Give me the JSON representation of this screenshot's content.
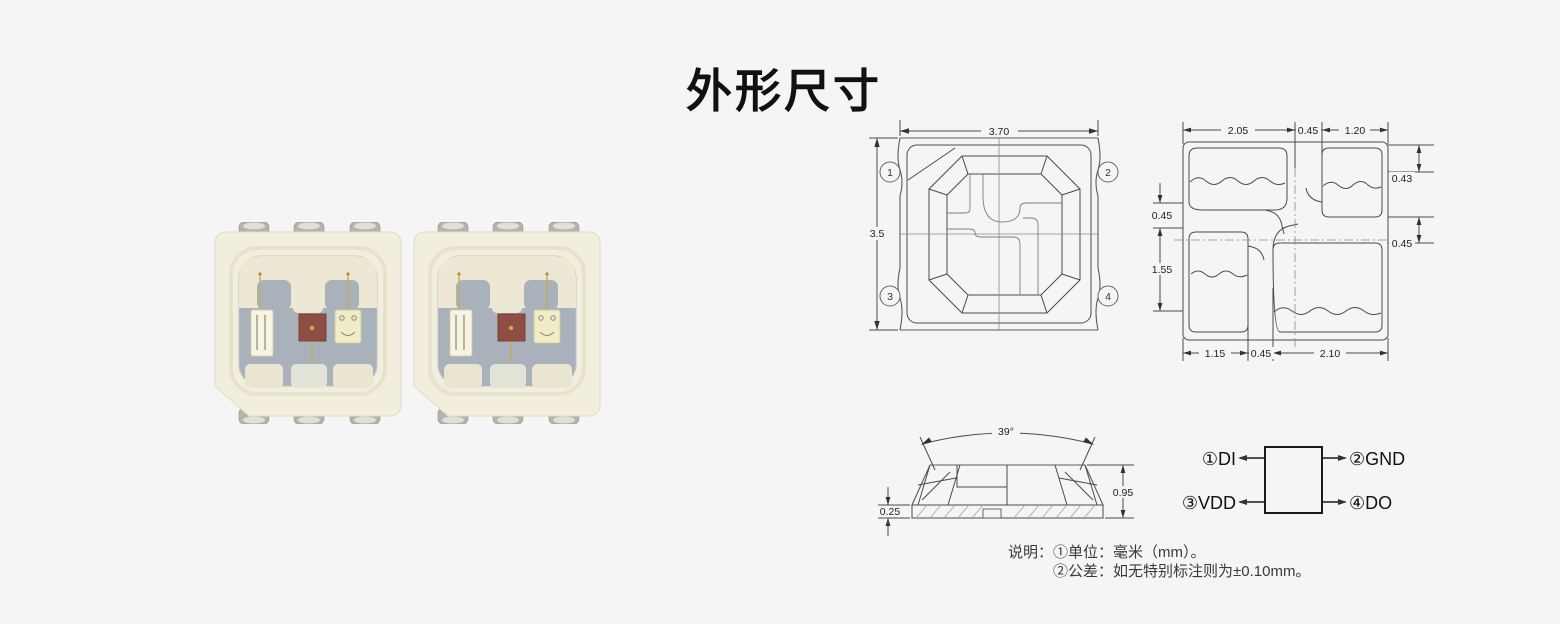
{
  "page": {
    "title": "外形尺寸",
    "background_color": "#f5f5f5",
    "drawing_line_color": "#4a4a4a"
  },
  "product_photo": {
    "led_count": 2,
    "body_color": "#f2eedd",
    "cavity_color": "#a9b2ba",
    "red_chip_color": "#8f4e44",
    "lead_color": "#b3b5ac"
  },
  "top_view": {
    "dim_width": "3.70",
    "dim_height": "3.5",
    "pin_markers": [
      "1",
      "2",
      "3",
      "4"
    ]
  },
  "pad_view": {
    "dim_top_left": "2.05",
    "dim_top_mid": "0.45",
    "dim_top_right": "1.20",
    "dim_right_top": "0.43",
    "dim_right_mid": "0.45",
    "dim_left_top": "0.45",
    "dim_left_mid": "1.55",
    "dim_bottom_left": "1.15",
    "dim_bottom_mid": "0.45",
    "dim_bottom_right": "2.10"
  },
  "side_view": {
    "dim_angle": "39°",
    "dim_height": "0.95",
    "dim_base": "0.25"
  },
  "pin_diagram": {
    "pin1": "①DI",
    "pin2": "②GND",
    "pin3": "③VDD",
    "pin4": "④DO"
  },
  "notes": {
    "label": "说明：",
    "line1": "①单位：毫米（mm）。",
    "line2": "②公差：如无特别标注则为±0.10mm。"
  }
}
